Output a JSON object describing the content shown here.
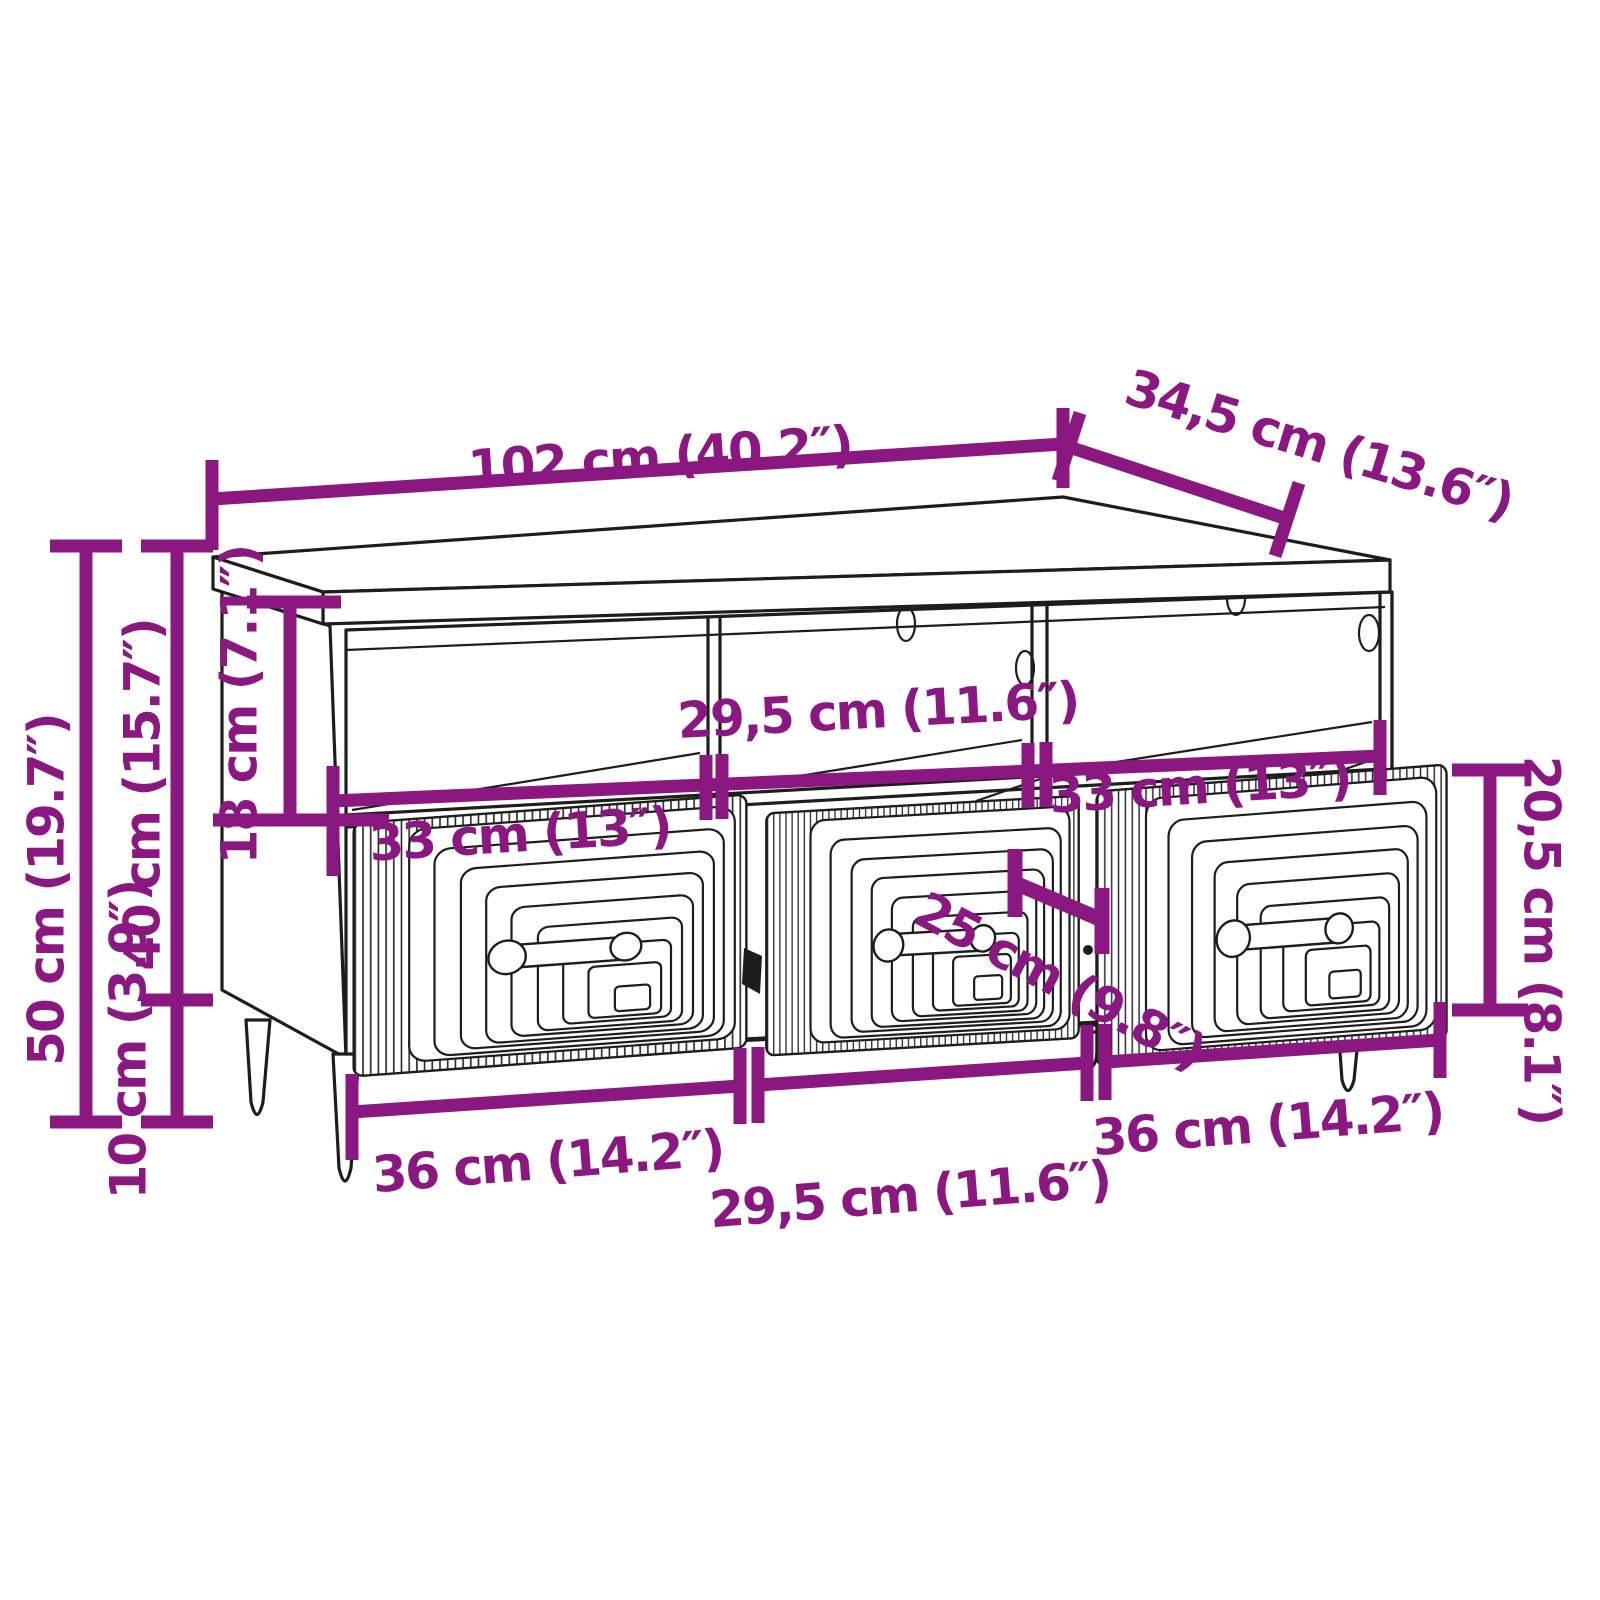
{
  "diagram": {
    "kind": "furniture-dimension-diagram",
    "item": "TV cabinet with three open compartments and three drawers on tapered legs",
    "units": [
      "cm",
      "inches"
    ],
    "colors": {
      "dimension_accent": "#8B1780",
      "outline": "#1d1d1b",
      "background": "#ffffff"
    },
    "labels": {
      "width_top": "102 cm (40.2″)",
      "depth_top": "34,5 cm (13.6″)",
      "height_total": "50 cm (19.7″)",
      "height_body": "40 cm (15.7″)",
      "height_legs": "10 cm (3.9″)",
      "compartment_height": "18 cm (7.1″)",
      "compartment_width_top": "29,5 cm (11.6″)",
      "drawer_width_top_left": "33 cm (13″)",
      "drawer_width_top_right": "33 cm (13″)",
      "drawer_inner_depth": "25 cm (9.8″)",
      "drawer_front_height": "20,5 cm (8.1″)",
      "drawer_width_bottom_left": "36 cm (14.2″)",
      "compartment_width_bottom": "29,5 cm (11.6″)",
      "drawer_width_bottom_right": "36 cm (14.2″)"
    }
  }
}
